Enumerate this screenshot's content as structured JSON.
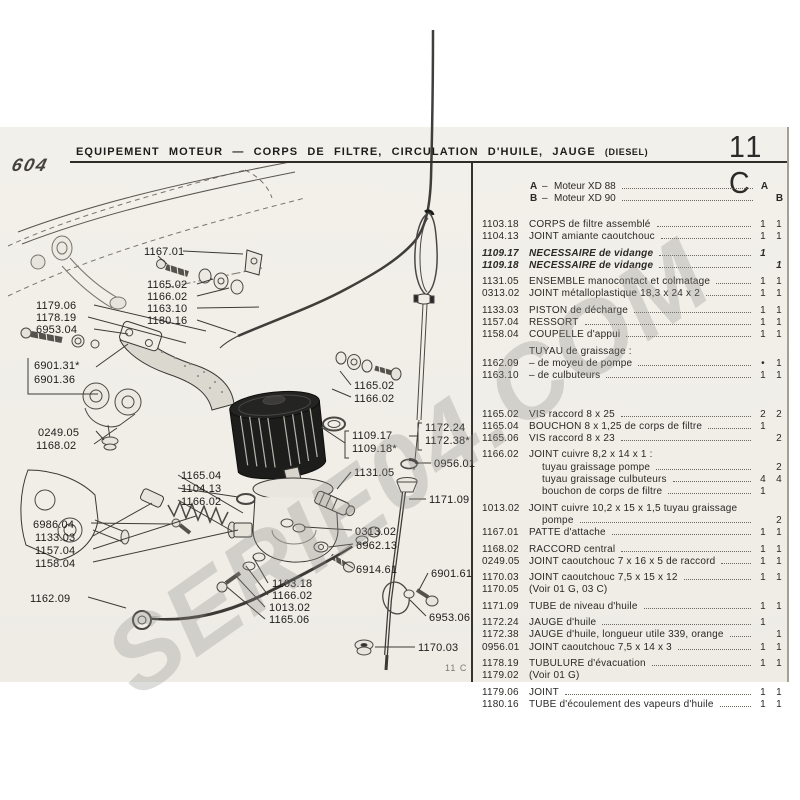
{
  "page": {
    "model": "604",
    "title_main": "EQUIPEMENT MOTEUR",
    "title_dash": "—",
    "title_rest": "CORPS DE FILTRE, CIRCULATION D'HUILE, JAUGE",
    "title_suffix": "(DIESEL)",
    "code": "11 C",
    "footer_code": "11 C",
    "watermark": "SERIE04.COM"
  },
  "legend": {
    "rows": [
      {
        "key": "A",
        "dash": "–",
        "label": "Moteur XD 88",
        "va": "A",
        "vb": ""
      },
      {
        "key": "B",
        "dash": "–",
        "label": "Moteur XD 90",
        "va": "",
        "vb": "B"
      }
    ]
  },
  "parts": {
    "rows": [
      {
        "ref": "1103.18",
        "desc": "CORPS de filtre assemblé",
        "a": "1",
        "b": "1"
      },
      {
        "ref": "1104.13",
        "desc": "JOINT amiante caoutchouc",
        "a": "1",
        "b": "1"
      },
      {
        "ref": "1109.17",
        "desc": "NECESSAIRE de vidange",
        "a": "1",
        "b": "",
        "italic": true,
        "gap": true
      },
      {
        "ref": "1109.18",
        "desc": "NECESSAIRE de vidange",
        "a": "",
        "b": "1",
        "italic": true
      },
      {
        "ref": "1131.05",
        "desc": "ENSEMBLE manocontact et colmatage",
        "a": "1",
        "b": "1",
        "gap": true
      },
      {
        "ref": "0313.02",
        "desc": "JOINT métalloplastique 18,3 x 24 x 2",
        "a": "1",
        "b": "1"
      },
      {
        "ref": "1133.03",
        "desc": "PISTON de décharge",
        "a": "1",
        "b": "1",
        "gap": true
      },
      {
        "ref": "1157.04",
        "desc": "RESSORT",
        "a": "1",
        "b": "1"
      },
      {
        "ref": "1158.04",
        "desc": "COUPELLE d'appui",
        "a": "1",
        "b": "1"
      },
      {
        "ref": "",
        "desc": "TUYAU de graissage :",
        "a": "",
        "b": "",
        "leader": false,
        "gap": true
      },
      {
        "ref": "1162.09",
        "desc": "– de moyeu de pompe",
        "a": "•",
        "b": "1"
      },
      {
        "ref": "1163.10",
        "desc": "– de culbuteurs",
        "a": "1",
        "b": "1"
      },
      {
        "ref": "1165.02",
        "desc": "VIS raccord 8 x 25",
        "a": "2",
        "b": "2",
        "biggap": true
      },
      {
        "ref": "1165.04",
        "desc": "BOUCHON 8 x 1,25 de corps de filtre",
        "a": "1",
        "b": ""
      },
      {
        "ref": "1165.06",
        "desc": "VIS raccord 8 x 23",
        "a": "",
        "b": "2"
      },
      {
        "ref": "1166.02",
        "desc": "JOINT cuivre 8,2 x 14 x 1 :",
        "a": "",
        "b": "",
        "leader": false,
        "gap": true
      },
      {
        "ref": "",
        "desc": "tuyau graissage pompe",
        "a": "",
        "b": "2",
        "indent": true
      },
      {
        "ref": "",
        "desc": "tuyau graissage culbuteurs",
        "a": "4",
        "b": "4",
        "indent": true
      },
      {
        "ref": "",
        "desc": "bouchon de corps de filtre",
        "a": "1",
        "b": "",
        "indent": true
      },
      {
        "ref": "1013.02",
        "desc": "JOINT cuivre 10,2 x 15 x 1,5 tuyau graissage",
        "a": "",
        "b": "",
        "leader": false,
        "gap": true
      },
      {
        "ref": "",
        "desc": "pompe",
        "a": "",
        "b": "2",
        "indent": true
      },
      {
        "ref": "1167.01",
        "desc": "PATTE d'attache",
        "a": "1",
        "b": "1"
      },
      {
        "ref": "1168.02",
        "desc": "RACCORD central",
        "a": "1",
        "b": "1",
        "gap": true
      },
      {
        "ref": "0249.05",
        "desc": "JOINT caoutchouc 7 x 16 x 5 de raccord",
        "a": "1",
        "b": "1"
      },
      {
        "ref": "1170.03",
        "desc": "JOINT caoutchouc 7,5 x 15 x 12",
        "a": "1",
        "b": "1",
        "gap": true
      },
      {
        "ref": "1170.05",
        "desc": "(Voir 01 G, 03 C)",
        "a": "",
        "b": "",
        "leader": false
      },
      {
        "ref": "1171.09",
        "desc": "TUBE de niveau d'huile",
        "a": "1",
        "b": "1",
        "gap": true
      },
      {
        "ref": "1172.24",
        "desc": "JAUGE d'huile",
        "a": "1",
        "b": "",
        "gap": true
      },
      {
        "ref": "1172.38",
        "desc": "JAUGE d'huile, longueur utile 339, orange",
        "a": "",
        "b": "1"
      },
      {
        "ref": "0956.01",
        "desc": "JOINT caoutchouc 7,5 x 14 x 3",
        "a": "1",
        "b": "1"
      },
      {
        "ref": "1178.19",
        "desc": "TUBULURE d'évacuation",
        "a": "1",
        "b": "1",
        "gap": true
      },
      {
        "ref": "1179.02",
        "desc": "(Voir 01 G)",
        "a": "",
        "b": "",
        "leader": false
      },
      {
        "ref": "1179.06",
        "desc": "JOINT",
        "a": "1",
        "b": "1",
        "gap": true
      },
      {
        "ref": "1180.16",
        "desc": "TUBE d'écoulement des vapeurs d'huile",
        "a": "1",
        "b": "1"
      }
    ]
  },
  "diagram": {
    "callouts": [
      {
        "label": "1167.01",
        "x": 144,
        "y": 246,
        "lines": [
          [
            [
              183,
              251
            ],
            [
              243,
              254
            ]
          ],
          [
            [
              158,
              256
            ],
            [
              167,
              264
            ]
          ]
        ]
      },
      {
        "label": "1165.02",
        "x": 147,
        "y": 279,
        "lines": [
          [
            [
              197,
              284
            ],
            [
              213,
              279
            ]
          ]
        ]
      },
      {
        "label": "1166.02",
        "x": 147,
        "y": 291,
        "lines": [
          [
            [
              197,
              296
            ],
            [
              229,
              288
            ]
          ]
        ]
      },
      {
        "label": "1163.10",
        "x": 147,
        "y": 303,
        "lines": [
          [
            [
              197,
              308
            ],
            [
              259,
              307
            ]
          ]
        ]
      },
      {
        "label": "1180.16",
        "x": 147,
        "y": 315,
        "lines": [
          [
            [
              197,
              320
            ],
            [
              236,
              333
            ]
          ]
        ]
      },
      {
        "label": "1179.06",
        "x": 36,
        "y": 300,
        "lines": [
          [
            [
              94,
              305
            ],
            [
              206,
              331
            ]
          ]
        ]
      },
      {
        "label": "1178.19",
        "x": 36,
        "y": 312,
        "lines": [
          [
            [
              88,
              317
            ],
            [
              186,
              343
            ]
          ]
        ]
      },
      {
        "label": "6953.04",
        "x": 36,
        "y": 324,
        "lines": [
          [
            [
              94,
              329
            ],
            [
              128,
              334
            ]
          ]
        ]
      },
      {
        "label": "6901.31*",
        "x": 34,
        "y": 360,
        "lines": [
          [
            [
              28,
              358
            ],
            [
              28,
              394
            ],
            [
              98,
              394
            ]
          ],
          [
            [
              96,
              367
            ],
            [
              128,
              344
            ]
          ]
        ]
      },
      {
        "label": "6901.36",
        "x": 34,
        "y": 374,
        "lines": []
      },
      {
        "label": "0249.05",
        "x": 38,
        "y": 427,
        "lines": [
          [
            [
              96,
              431
            ],
            [
              104,
              440
            ]
          ]
        ]
      },
      {
        "label": "1168.02",
        "x": 36,
        "y": 440,
        "lines": [
          [
            [
              94,
              444
            ],
            [
              117,
              428
            ]
          ]
        ]
      },
      {
        "label": "6986.04",
        "x": 33,
        "y": 519,
        "lines": [
          [
            [
              91,
              523
            ],
            [
              172,
              524
            ]
          ]
        ]
      },
      {
        "label": "1133.03",
        "x": 35,
        "y": 532,
        "lines": [
          [
            [
              93,
              536
            ],
            [
              152,
              503
            ]
          ]
        ]
      },
      {
        "label": "1157.04",
        "x": 35,
        "y": 545,
        "lines": [
          [
            [
              93,
              549
            ],
            [
              196,
              516
            ]
          ]
        ]
      },
      {
        "label": "1158.04",
        "x": 35,
        "y": 558,
        "lines": [
          [
            [
              93,
              562
            ],
            [
              238,
              530
            ]
          ]
        ]
      },
      {
        "label": "1162.09",
        "x": 30,
        "y": 593,
        "lines": [
          [
            [
              88,
              597
            ],
            [
              126,
              608
            ]
          ]
        ]
      },
      {
        "label": "1165.04",
        "x": 181,
        "y": 470,
        "lines": [
          [
            [
              178,
              475
            ],
            [
              243,
              513
            ]
          ]
        ]
      },
      {
        "label": "1104.13",
        "x": 181,
        "y": 483,
        "lines": [
          [
            [
              178,
              488
            ],
            [
              238,
              497
            ]
          ]
        ]
      },
      {
        "label": "1166.02",
        "x": 181,
        "y": 496,
        "lines": [
          [
            [
              178,
              500
            ],
            [
              232,
              531
            ]
          ]
        ]
      },
      {
        "label": "1109.17",
        "x": 352,
        "y": 430,
        "lines": [
          [
            [
              349,
              431
            ],
            [
              345,
              431
            ],
            [
              345,
              458
            ],
            [
              349,
              458
            ]
          ],
          [
            [
              345,
              443
            ],
            [
              321,
              427
            ]
          ]
        ]
      },
      {
        "label": "1109.18*",
        "x": 352,
        "y": 443,
        "lines": []
      },
      {
        "label": "1131.05",
        "x": 354,
        "y": 467,
        "lines": [
          [
            [
              351,
              472
            ],
            [
              337,
              489
            ]
          ]
        ]
      },
      {
        "label": "1172.24",
        "x": 425,
        "y": 422,
        "lines": [
          [
            [
              422,
              423
            ],
            [
              418,
              423
            ],
            [
              418,
              450
            ],
            [
              422,
              450
            ]
          ],
          [
            [
              418,
              436
            ],
            [
              409,
              436
            ]
          ]
        ]
      },
      {
        "label": "1172.38*",
        "x": 425,
        "y": 435,
        "lines": []
      },
      {
        "label": "0956.01",
        "x": 434,
        "y": 458,
        "lines": [
          [
            [
              431,
              463
            ],
            [
              418,
              463
            ]
          ]
        ]
      },
      {
        "label": "1171.09",
        "x": 429,
        "y": 494,
        "lines": [
          [
            [
              426,
              499
            ],
            [
              409,
              499
            ]
          ]
        ]
      },
      {
        "label": "0313.02",
        "x": 355,
        "y": 526,
        "lines": [
          [
            [
              352,
              530
            ],
            [
              305,
              527
            ]
          ]
        ]
      },
      {
        "label": "6962.13",
        "x": 356,
        "y": 540,
        "lines": [
          [
            [
              353,
              544
            ],
            [
              329,
              547
            ]
          ]
        ]
      },
      {
        "label": "6914.61",
        "x": 356,
        "y": 564,
        "lines": [
          [
            [
              353,
              568
            ],
            [
              345,
              563
            ]
          ]
        ]
      },
      {
        "label": "6901.61",
        "x": 431,
        "y": 568,
        "lines": [
          [
            [
              428,
              573
            ],
            [
              419,
              590
            ]
          ]
        ]
      },
      {
        "label": "6953.06",
        "x": 429,
        "y": 612,
        "lines": [
          [
            [
              426,
              616
            ],
            [
              410,
              600
            ]
          ]
        ]
      },
      {
        "label": "1170.03",
        "x": 418,
        "y": 642,
        "lines": [
          [
            [
              415,
              647
            ],
            [
              375,
              647
            ]
          ]
        ]
      },
      {
        "label": "1103.18",
        "x": 272,
        "y": 578,
        "lines": [
          [
            [
              268,
              583
            ],
            [
              253,
              557
            ]
          ]
        ]
      },
      {
        "label": "1166.02",
        "x": 272,
        "y": 590,
        "lines": [
          [
            [
              268,
              595
            ],
            [
              246,
              566
            ]
          ]
        ]
      },
      {
        "label": "1013.02",
        "x": 269,
        "y": 602,
        "lines": [
          [
            [
              265,
              607
            ],
            [
              236,
              576
            ]
          ]
        ]
      },
      {
        "label": "1165.06",
        "x": 269,
        "y": 614,
        "lines": [
          [
            [
              265,
              619
            ],
            [
              227,
              587
            ]
          ]
        ]
      },
      {
        "label": "1165.02",
        "x": 354,
        "y": 380,
        "lines": [
          [
            [
              351,
              385
            ],
            [
              340,
              371
            ]
          ]
        ]
      },
      {
        "label": "1166.02",
        "x": 354,
        "y": 393,
        "lines": [
          [
            [
              351,
              397
            ],
            [
              332,
              389
            ]
          ]
        ]
      }
    ]
  }
}
